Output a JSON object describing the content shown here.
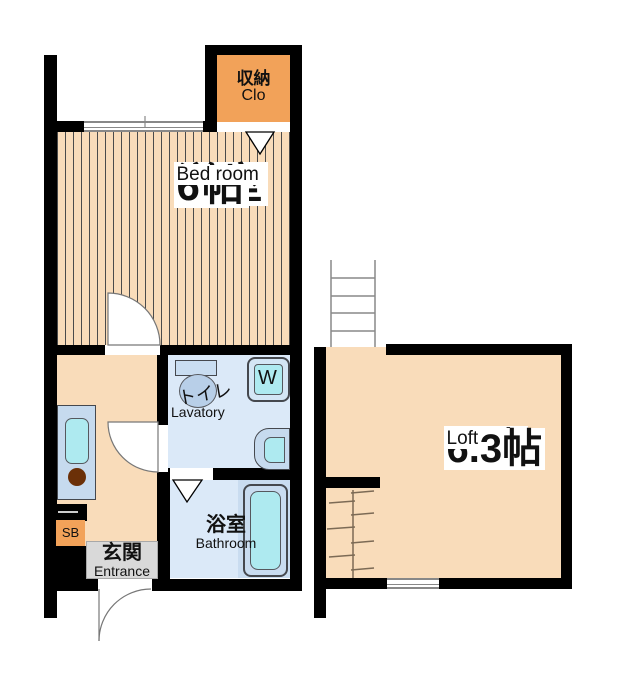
{
  "plan_title": "apartment-floor-plan",
  "rooms": {
    "bedroom": {
      "name_jp": "洋室",
      "size": "6帖",
      "name_en": "Bed room"
    },
    "closet": {
      "name_jp": "収納",
      "name_en": "Clo"
    },
    "lavatory": {
      "name_jp": "トイレ",
      "name_en": "Lavatory"
    },
    "bathroom": {
      "name_jp": "浴室",
      "name_en": "Bathroom"
    },
    "entrance": {
      "name_jp": "玄関",
      "name_en": "Entrance"
    },
    "loft": {
      "name_jp": "ロフト",
      "size": "6.3帖",
      "name_en": "Loft"
    },
    "shoe_box": {
      "label": "SB"
    },
    "washer": {
      "label": "W"
    }
  },
  "colors": {
    "floor_peach": "#f9dcba",
    "closet_orange": "#f2a259",
    "wet_area_blue": "#dbe9f8",
    "fixture_blue": "#c6daee",
    "basin_cyan": "#aeeaf0",
    "entrance_gray": "#d9d9d9",
    "wall_black": "#000000",
    "burner_brown": "#6b3008"
  }
}
